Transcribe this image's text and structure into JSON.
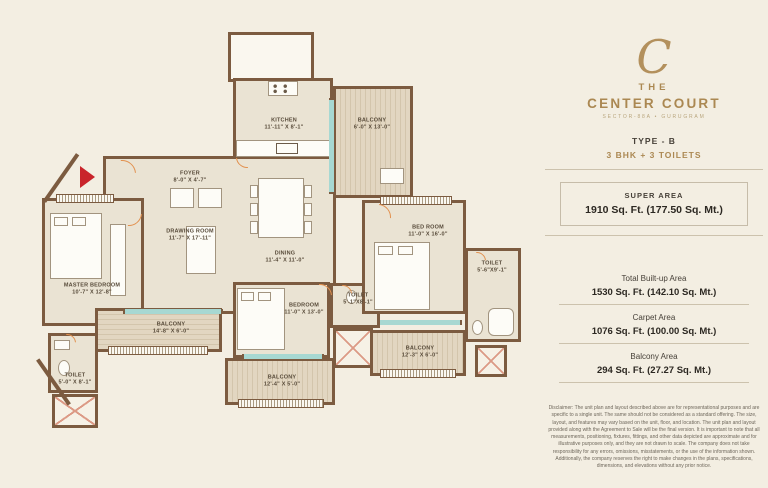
{
  "panel": {
    "logo_monogram": "C",
    "brand_line1": "THE",
    "brand_line2": "CENTER COURT",
    "brand_subtitle": "SECTOR-88A • GURUGRAM",
    "type_label": "TYPE - B",
    "config_label": "3 BHK + 3 TOILETS",
    "super_area": {
      "label": "SUPER AREA",
      "value": "1910 Sq. Ft.  (177.50 Sq. Mt.)"
    },
    "areas": [
      {
        "label": "Total Built-up Area",
        "value": "1530 Sq. Ft. (142.10 Sq. Mt.)"
      },
      {
        "label": "Carpet Area",
        "value": "1076 Sq. Ft. (100.00 Sq. Mt.)"
      },
      {
        "label": "Balcony Area",
        "value": "294 Sq. Ft. (27.27 Sq. Mt.)"
      }
    ],
    "disclaimer": "Disclaimer: The unit plan and layout described above are for representational purposes and are specific to a single unit. The same should not be considered as a standard offering. The size, layout, and features may vary based on the unit, floor, and location. The unit plan and layout provided along with the Agreement to Sale will be the final version. It is important to note that all measurements, positioning, fixtures, fittings, and other data depicted are approximate and for illustrative purposes only, and they are not drawn to scale. The company does not take responsibility for any errors, omissions, misstatements, or the use of the information shown. Additionally, the company reserves the right to make changes in the plans, specifications, dimensions, and elevations without any prior notice."
  },
  "plan": {
    "rooms": {
      "kitchen": {
        "name": "KITCHEN",
        "dims": "11'-11\" X 8'-1\""
      },
      "balcony_top": {
        "name": "BALCONY",
        "dims": "6'-0\" X 13'-0\""
      },
      "foyer": {
        "name": "FOYER",
        "dims": "8'-0\" X 4'-7\""
      },
      "drawing_room": {
        "name": "DRAWING ROOM",
        "dims": "11'-7\" X 17'-11\""
      },
      "dining": {
        "name": "DINING",
        "dims": "11'-4\" X 11'-0\""
      },
      "bed_room": {
        "name": "BED ROOM",
        "dims": "11'-0\" X 16'-0\""
      },
      "toilet_right": {
        "name": "TOILET",
        "dims": "5'-6\"X9'-1\""
      },
      "master_bedroom": {
        "name": "MASTER BEDROOM",
        "dims": "10'-7\" X 12'-8\""
      },
      "toilet_master": {
        "name": "TOILET",
        "dims": "5'-0\" X 8'-1\""
      },
      "balcony_left": {
        "name": "BALCONY",
        "dims": "14'-8\" X 6'-0\""
      },
      "bedroom": {
        "name": "BEDROOM",
        "dims": "11'-0\" X 13'-0\""
      },
      "toilet_mid": {
        "name": "TOILET",
        "dims": "5'-1\"X8'-1\""
      },
      "balcony_mid": {
        "name": "BALCONY",
        "dims": "12'-4\" X 5'-0\""
      },
      "balcony_right": {
        "name": "BALCONY",
        "dims": "12'-3\" X 6'-0\""
      }
    }
  },
  "colors": {
    "background": "#f3eee2",
    "room_fill": "#eae3d3",
    "balcony_fill": "#d9ccb4",
    "wall_brown": "#7c5b40",
    "accent_gold": "#ab8852",
    "text_dark": "#2c2822",
    "entry_arrow_red": "#c9242b",
    "door_arc_orange": "#e2914f",
    "window_teal": "#a7d8d2"
  }
}
